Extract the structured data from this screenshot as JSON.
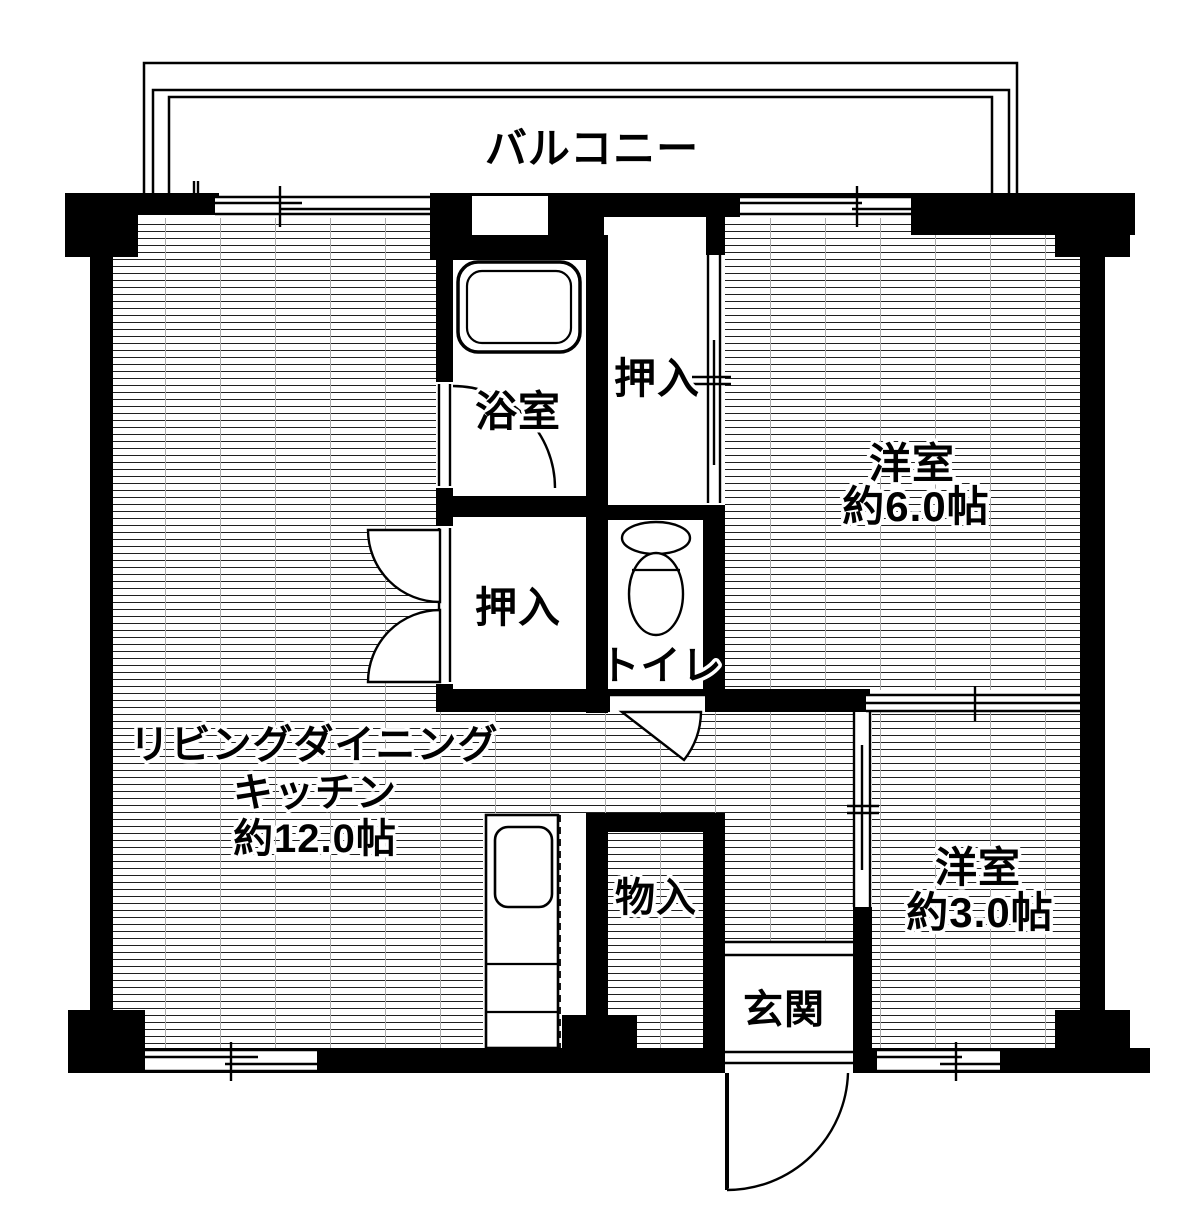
{
  "floorplan": {
    "balcony_label": "バルコニー",
    "ldk_line1": "リビングダイニング",
    "ldk_line2": "キッチン",
    "ldk_line3": "約12.0帖",
    "bathroom_label": "浴室",
    "closet_upper_label": "押入",
    "closet_lower_label": "押入",
    "toilet_label": "トイレ",
    "western6_label": "洋室",
    "western6_size": "約6.0帖",
    "western3_label": "洋室",
    "western3_size": "約3.0帖",
    "storage_label": "物入",
    "entrance_label": "玄関"
  },
  "colors": {
    "wall": "#000000",
    "background": "#ffffff",
    "hatch_line": "#1f1f1f",
    "hatch_grid": "#aaaaaa"
  },
  "fixtures": {
    "bathtub": "bathtub-icon",
    "toilet_bowl": "toilet-icon",
    "kitchen_sink": "kitchen-sink-icon",
    "entry_door": "swing-door-icon",
    "bath_door": "swing-door-icon",
    "toilet_door": "swing-door-icon",
    "closet_doors": "double-swing-door-icon",
    "sliding_door": "sliding-door-icon",
    "windows": "window-icon"
  }
}
